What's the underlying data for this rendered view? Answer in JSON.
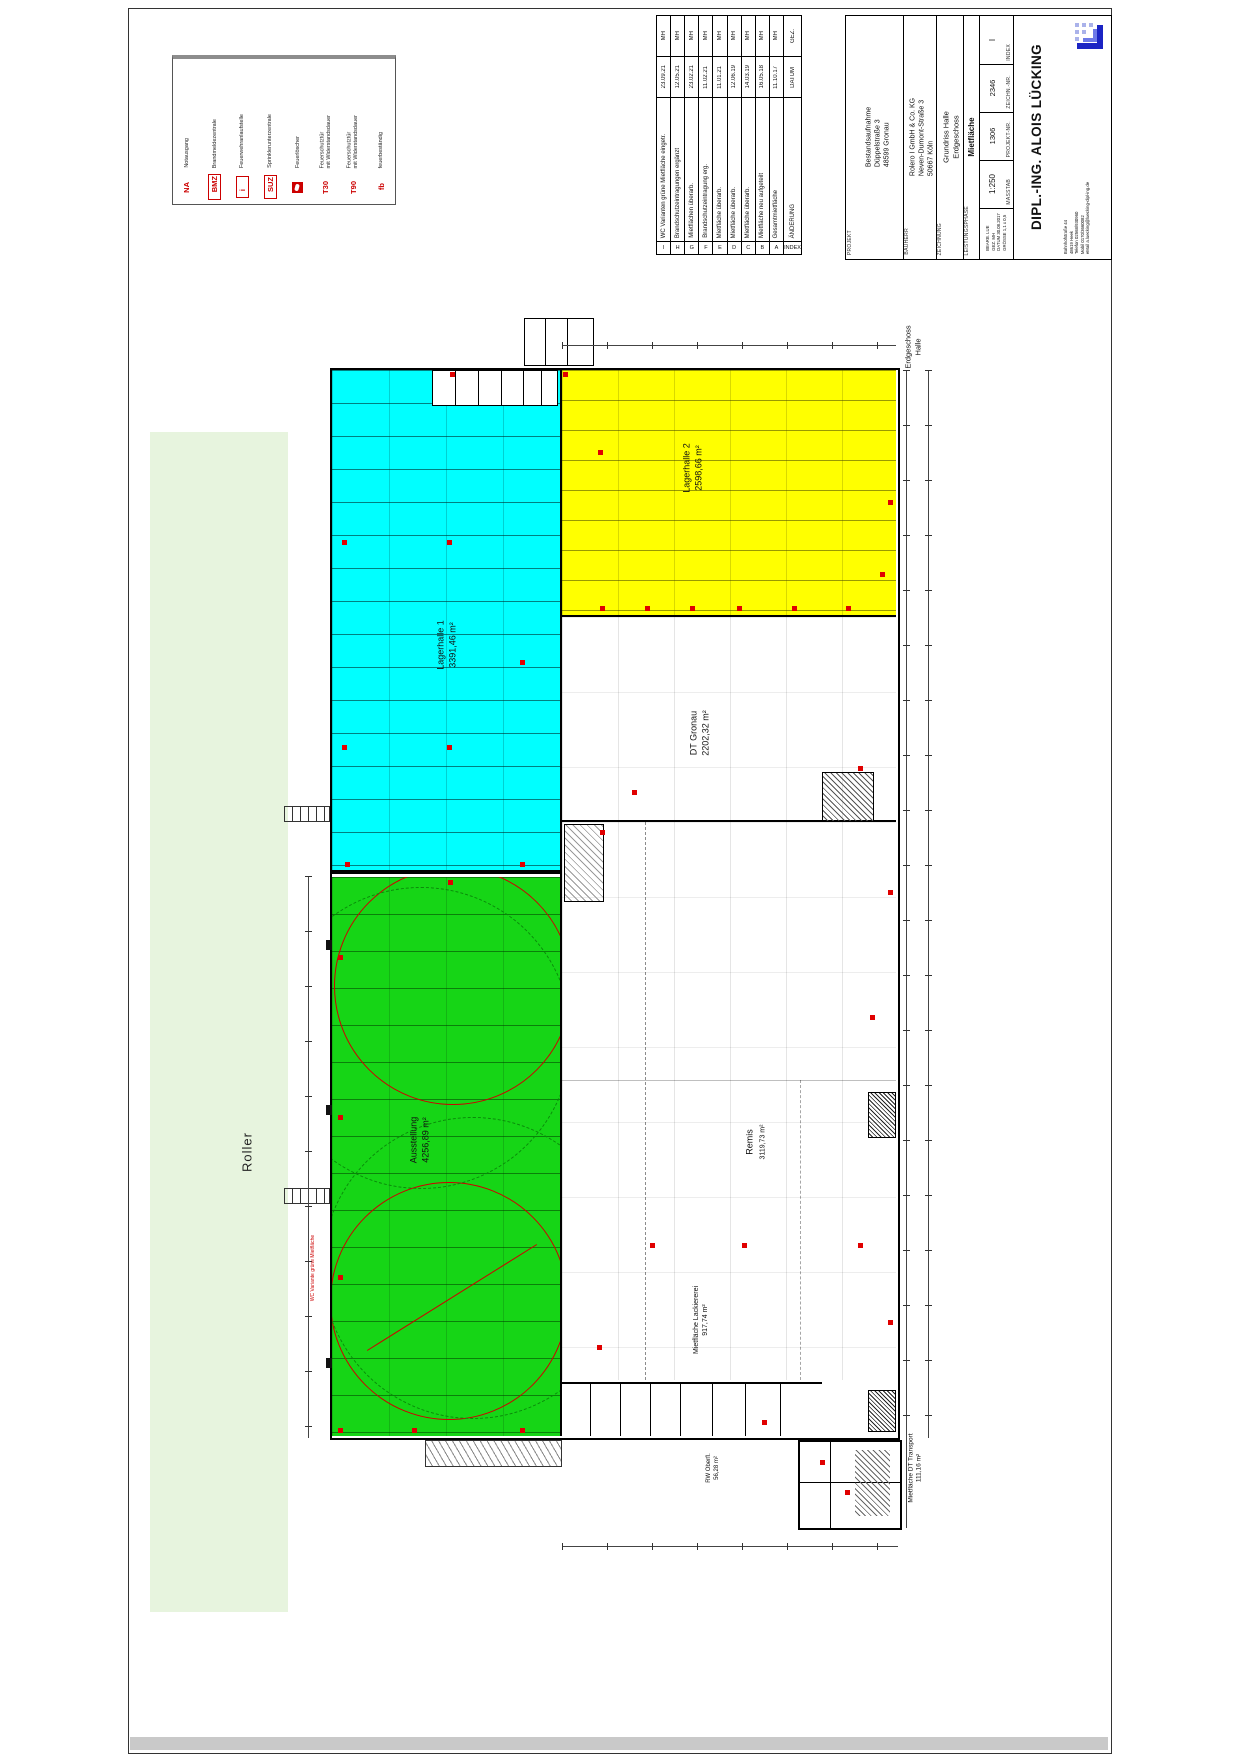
{
  "legend": {
    "items": [
      {
        "code": "NA",
        "label": "Notausgang",
        "label2": ""
      },
      {
        "code": "BMZ",
        "label": "Brandmeldezentrale",
        "label2": ""
      },
      {
        "code": "i",
        "label": "Feuerwehranlaufstelle",
        "label2": ""
      },
      {
        "code": "SUZ",
        "label": "Sprinklerunterzentrale",
        "label2": ""
      },
      {
        "code": "",
        "label": "Feuerlöscher",
        "label2": ""
      },
      {
        "code": "T30",
        "label": "Feuerschutztür",
        "label2": "mit Widerstandsdauer"
      },
      {
        "code": "T90",
        "label": "Feuerschutztür",
        "label2": "mit Widerstandsdauer"
      },
      {
        "code": "fb",
        "label": "feuerbeständig",
        "label2": ""
      }
    ]
  },
  "revisions": {
    "header": {
      "index": "INDEX",
      "change": "ÄNDERUNG",
      "date": "DATUM",
      "gez": "GEZ."
    },
    "rows": [
      {
        "index": "I",
        "change": "WC Varianten grüne Mietfläche eingetr.",
        "date": "23.09.21",
        "gez": "MH"
      },
      {
        "index": "H",
        "change": "Brandschutzeintragungen ergänzt",
        "date": "12.05.21",
        "gez": "MH"
      },
      {
        "index": "G",
        "change": "Mietflächen überarb.",
        "date": "23.02.21",
        "gez": "MH"
      },
      {
        "index": "F",
        "change": "Brandschutzeintragung erg.",
        "date": "11.02.21",
        "gez": "MH"
      },
      {
        "index": "E",
        "change": "Mietfläche überarb.",
        "date": "11.01.21",
        "gez": "MH"
      },
      {
        "index": "D",
        "change": "Mietfläche überarb.",
        "date": "12.06.19",
        "gez": "MH"
      },
      {
        "index": "C",
        "change": "Mietfläche überarb.",
        "date": "14.03.19",
        "gez": "MH"
      },
      {
        "index": "B",
        "change": "Mietfläche neu aufgeteilt",
        "date": "16.05.18",
        "gez": "MH"
      },
      {
        "index": "A",
        "change": "Gesamtmietfläche",
        "date": "11.10.17",
        "gez": "MH"
      }
    ]
  },
  "titleblock": {
    "projekt": {
      "label": "PROJEKT",
      "line1": "Bestandsaufnahme",
      "line2": "Düppelstraße 3",
      "line3": "48599 Gronau"
    },
    "bauherr": {
      "label": "BAUHERR",
      "line1": "Rolero I GmbH & Co. KG",
      "line2": "Neven-Dumont-Straße 3",
      "line3": "50667 Köln"
    },
    "zeichnung": {
      "label": "ZEICHNUNG",
      "line1": "Grundriss Halle",
      "line2": "Erdgeschoss"
    },
    "leistungsphase": {
      "label": "LEISTUNGSPHASE",
      "value": "Mietfläche"
    },
    "fields": {
      "index": {
        "label": "INDEX",
        "value": "I"
      },
      "zeichn_nr": {
        "label": "ZEICHN.-NR.",
        "value": "2346"
      },
      "projekt_nr": {
        "label": "PROJEKT-NR.",
        "value": "1306"
      },
      "massstab": {
        "label": "MASSTAB",
        "value": "1:250"
      }
    },
    "meta": {
      "line1": "BEARB. LUE",
      "line2": "GEZ. MH",
      "line3": "DATUM 30.08.2017",
      "line4": "GRÖSSE 1,1 x 0,5"
    },
    "architect": {
      "name": "DIPL.-ING. ALOIS LÜCKING",
      "addr1": "Bahnhofstraße 44",
      "addr2": "48619 Heek",
      "addr3": "Telefon 02568/930960",
      "addr4": "Mobil 0170/3660082",
      "addr5": "eMail a.luecking@luecking-dipl-ing.de"
    }
  },
  "plan": {
    "neighbor_label": "Roller",
    "floor_label1": "Erdgeschoss",
    "floor_label2": "Halle",
    "note_red": "WC Variante grüne Mietfläche",
    "areas": {
      "lagerhalle1": {
        "name": "Lagerhalle 1",
        "size": "3391,46 m²",
        "color": "#00ffff"
      },
      "lagerhalle2": {
        "name": "Lagerhalle 2",
        "size": "2598,66 m²",
        "color": "#ffff00"
      },
      "dt_gronau": {
        "name": "DT Gronau",
        "size": "2202,32 m²",
        "color": "#ffffff"
      },
      "ausstellung": {
        "name": "Ausstellung",
        "size": "4256,89 m²",
        "color": "#16d516"
      },
      "remis": {
        "name": "Remis",
        "size": "3119,73 m²",
        "color": "#ffffff"
      },
      "lackiererei": {
        "name": "Mietfläche Lackiererei",
        "size": "917,74 m²"
      },
      "rw": {
        "name": "RW Oberfl.",
        "size": "56,28 m²"
      },
      "dt_transport": {
        "name": "Mietfläche DT Transport",
        "size": "111,16 m²"
      }
    }
  }
}
